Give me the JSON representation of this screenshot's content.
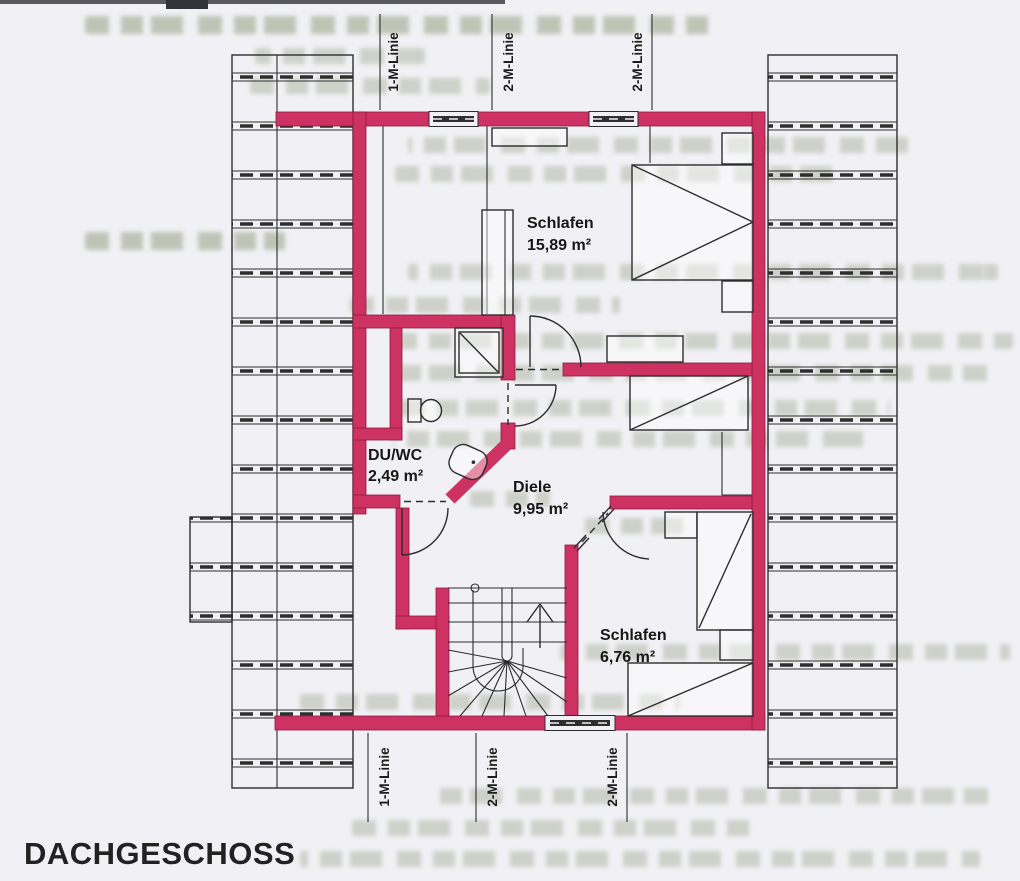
{
  "page": {
    "title": "DACHGESCHOSS"
  },
  "floor_plan": {
    "rooms": [
      {
        "name": "Schlafen",
        "area": "15,89 m²"
      },
      {
        "name": "DU/WC",
        "area": "2,49 m²"
      },
      {
        "name": "Diele",
        "area": "9,95 m²"
      },
      {
        "name": "Schlafen",
        "area": "6,76 m²"
      }
    ],
    "measure_lines": {
      "top": [
        {
          "label": "1-M-Linie"
        },
        {
          "label": "2-M-Linie"
        },
        {
          "label": "2-M-Linie"
        }
      ],
      "bottom": [
        {
          "label": "1-M-Linie"
        },
        {
          "label": "2-M-Linie"
        },
        {
          "label": "2-M-Linie"
        }
      ]
    },
    "stair_arrow": "up",
    "colors": {
      "wall": "#ce3262",
      "wall_edge": "#8e1a42",
      "line": "#2d2d2d",
      "paper": "#f1f0f4",
      "ghost": "#9fa88f",
      "label": "#171717"
    }
  }
}
